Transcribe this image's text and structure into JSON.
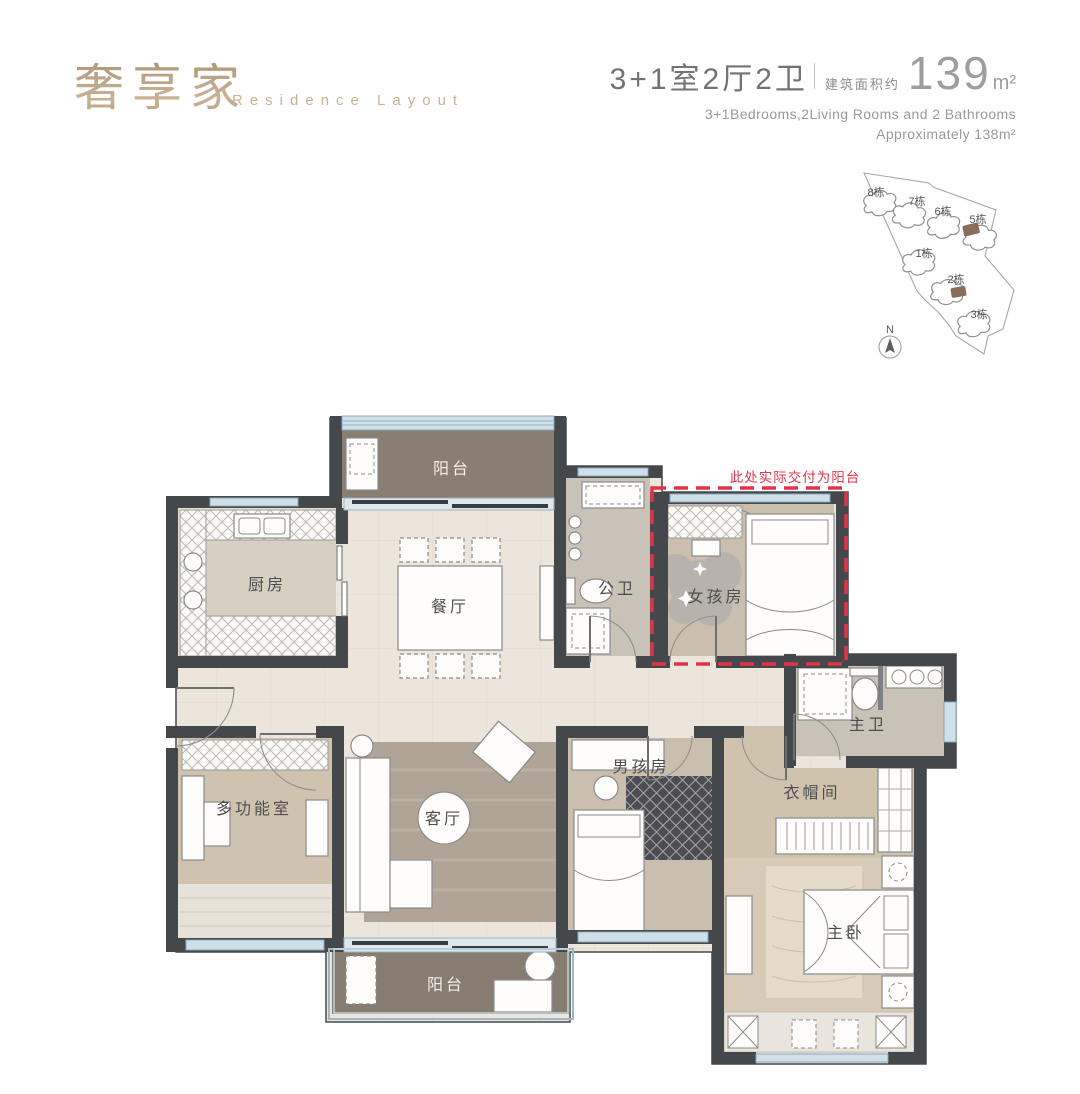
{
  "header": {
    "title_cn": "奢享家",
    "title_en": "Residence Layout",
    "spec_cn": "3+1室2厅2卫",
    "area_label_cn": "建筑面积约",
    "area_value": "139",
    "area_unit": "m²",
    "spec_en": "3+1Bedrooms,2Living Rooms and 2 Bathrooms",
    "area_en": "Approximately 138m²"
  },
  "sitemap": {
    "compass_label": "N",
    "buildings": [
      {
        "label": "8栋"
      },
      {
        "label": "7栋"
      },
      {
        "label": "6栋"
      },
      {
        "label": "5栋"
      },
      {
        "label": "1栋"
      },
      {
        "label": "2栋"
      },
      {
        "label": "3栋"
      }
    ]
  },
  "floorplan": {
    "annotation": "此处实际交付为阳台",
    "rooms": {
      "balcony_top": "阳台",
      "kitchen": "厨房",
      "dining": "餐厅",
      "public_bath": "公卫",
      "girl_room": "女孩房",
      "multi_room": "多功能室",
      "living": "客厅",
      "boy_room": "男孩房",
      "master_bath": "主卫",
      "cloak_room": "衣帽间",
      "master_bed": "主卧",
      "balcony_bottom": "阳台"
    }
  },
  "colors": {
    "accent_gold": "#b29878",
    "annotation_red": "#e23448",
    "wall": "#45484b",
    "window_blue": "#cfe0ea",
    "balcony_floor": "#8a7e72",
    "tile_floor": "#ece5db",
    "wood_floor": "#cabeae",
    "bath_floor": "#c9c2b6",
    "highlight_unit": "#8a6c5a"
  }
}
